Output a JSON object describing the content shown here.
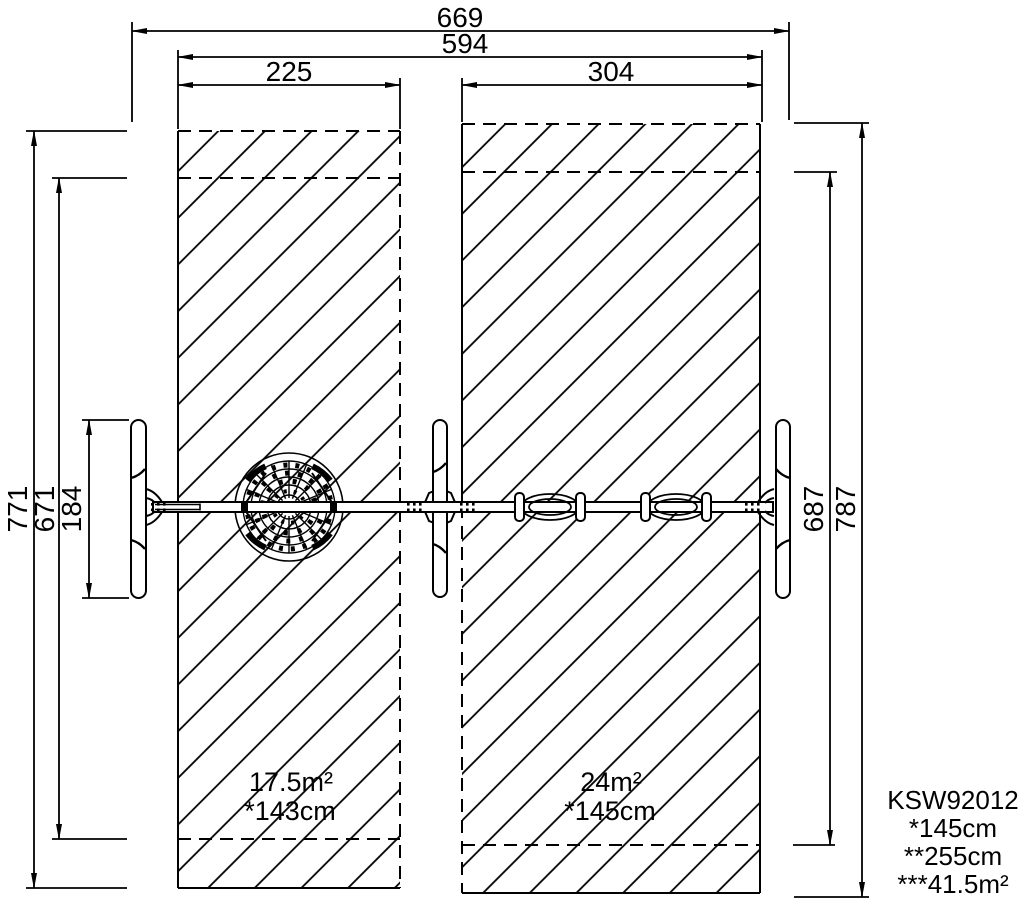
{
  "drawing": {
    "line_color": "#000000",
    "background": "#ffffff",
    "dimensions": {
      "overall_width": "669",
      "frame_width": "594",
      "left_zone_width": "225",
      "right_zone_width": "304",
      "left_zone_height": "771",
      "left_inner_height": "671",
      "post_length": "184",
      "right_zone_height": "787",
      "right_inner_height": "687"
    },
    "zones": {
      "left": {
        "area": "17.5m²",
        "fall_height": "*143cm"
      },
      "right": {
        "area": "24m²",
        "fall_height": "*145cm"
      }
    },
    "legend": {
      "product_code": "KSW92012",
      "line1": "*145cm",
      "line2": "**255cm",
      "line3": "***41.5m²"
    }
  }
}
